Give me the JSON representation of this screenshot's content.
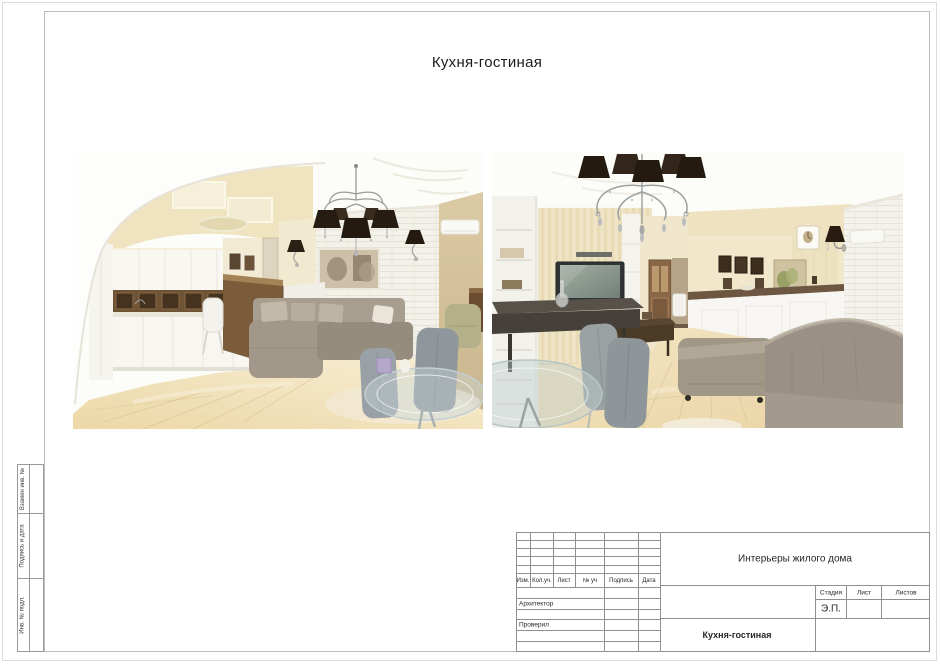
{
  "sheet": {
    "title": "Кухня-гостиная"
  },
  "sidebar": {
    "labels": [
      "Взамен инв. №",
      "Подпись и дата",
      "Инв. № подл."
    ]
  },
  "title_block": {
    "columns": [
      "Изм.",
      "Кол.уч.",
      "Лист",
      "№ уч",
      "Подпись",
      "Дата"
    ],
    "rows": [
      "",
      "Архитектор",
      "",
      "Проверил",
      "",
      ""
    ],
    "project": "Интерьеры жилого дома",
    "stage_columns": [
      "Стадия",
      "Лист",
      "Листов"
    ],
    "stage_value": "Э.П.",
    "sheet_name": "Кухня-гостиная"
  },
  "palette": {
    "frame_line": "#bdbdbd",
    "stamp_line": "#8f8f8f",
    "text": "#222222",
    "wall_cream": "#f1e5c3",
    "floor_wood": "#eedcb2",
    "sofa_gray": "#a39a8b",
    "bar_wood": "#7a5c3b",
    "lamp_shade": "#241a10",
    "brick_white": "#f3f1ea",
    "chair_gray": "#98a0a5"
  }
}
